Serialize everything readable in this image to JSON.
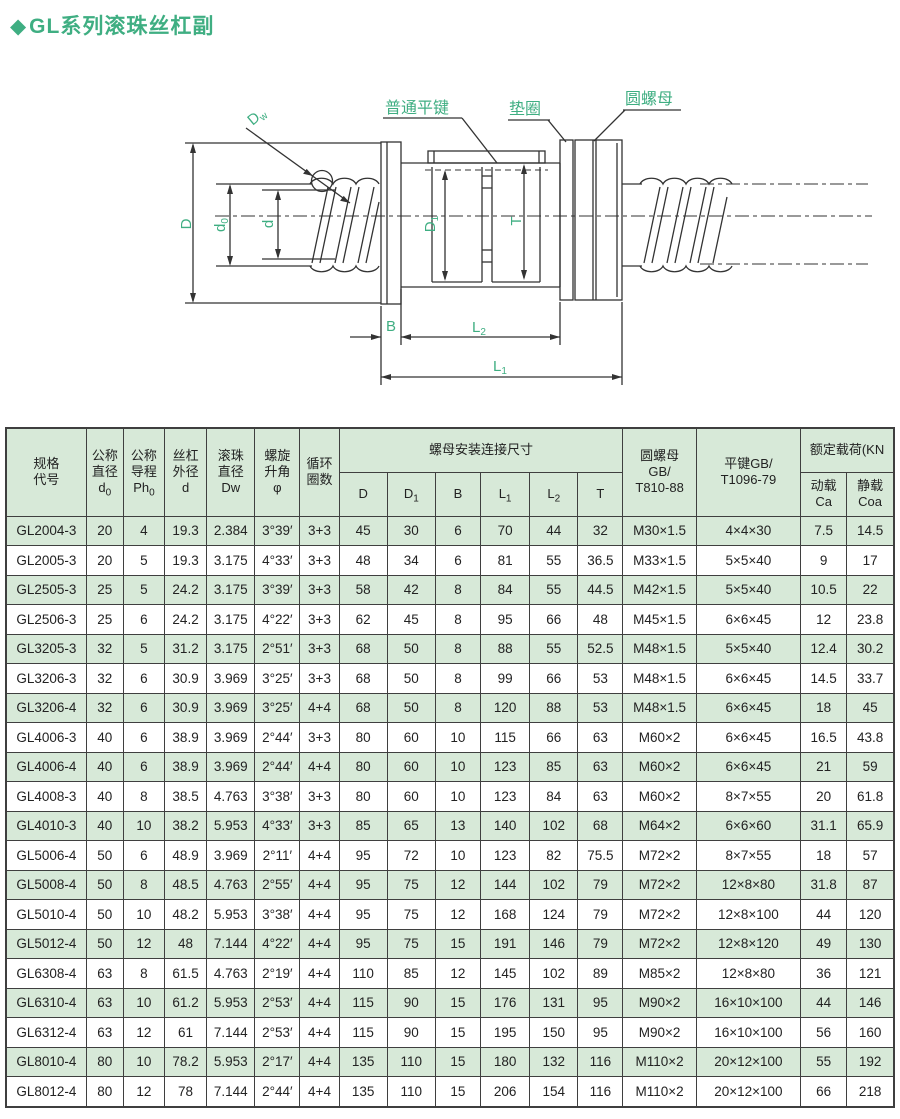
{
  "title": {
    "diamond": "◆",
    "text": "GL系列滚珠丝杠副"
  },
  "colors": {
    "accent_green": "#3fae82",
    "row_green": "#d7e9d8",
    "line_color": "#333333"
  },
  "diagram": {
    "callouts": {
      "flat_key": "普通平键",
      "washer": "垫圈",
      "round_nut": "圆螺母"
    },
    "dims": {
      "D": "D",
      "d0": {
        "sym": "d",
        "sub": "0"
      },
      "d": "d",
      "Dw": {
        "sym": "D",
        "sub": "w"
      },
      "D1": {
        "sym": "D",
        "sub": "1"
      },
      "T": "T",
      "B": "B",
      "L1": {
        "sym": "L",
        "sub": "1"
      },
      "L2": {
        "sym": "L",
        "sub": "2"
      }
    }
  },
  "table": {
    "header": {
      "spec_code": "规格\n代号",
      "nominal_diameter": {
        "label": "公称\n直径",
        "sym": "d",
        "sub": "0"
      },
      "nominal_lead": {
        "label": "公称\n导程",
        "sym": "Ph",
        "sub": "0"
      },
      "screw_od": {
        "label": "丝杠\n外径",
        "sym": "d",
        "sub": ""
      },
      "ball_diameter": {
        "label": "滚珠\n直径",
        "sym": "Dw",
        "sub": ""
      },
      "helix_angle": {
        "label": "螺旋\n升角",
        "sym": "φ",
        "sub": ""
      },
      "circuits": "循环\n圈数",
      "nut_mount_dims": "螺母安装连接尺寸",
      "round_nut_std": "圆螺母\nGB/\nT810-88",
      "flat_key_std": "平键GB/\nT1096-79",
      "rated_load": "额定载荷(KN",
      "dim_cols": [
        {
          "sym": "D",
          "sub": ""
        },
        {
          "sym": "D",
          "sub": "1"
        },
        {
          "sym": "B",
          "sub": ""
        },
        {
          "sym": "L",
          "sub": "1"
        },
        {
          "sym": "L",
          "sub": "2"
        },
        {
          "sym": "T",
          "sub": ""
        }
      ],
      "load_cols": [
        "动载\nCa",
        "静载\nCoa"
      ]
    },
    "rows": [
      [
        "GL2004-3",
        "20",
        "4",
        "19.3",
        "2.384",
        "3°39′",
        "3+3",
        "45",
        "30",
        "6",
        "70",
        "44",
        "32",
        "M30×1.5",
        "4×4×30",
        "7.5",
        "14.5"
      ],
      [
        "GL2005-3",
        "20",
        "5",
        "19.3",
        "3.175",
        "4°33′",
        "3+3",
        "48",
        "34",
        "6",
        "81",
        "55",
        "36.5",
        "M33×1.5",
        "5×5×40",
        "9",
        "17"
      ],
      [
        "GL2505-3",
        "25",
        "5",
        "24.2",
        "3.175",
        "3°39′",
        "3+3",
        "58",
        "42",
        "8",
        "84",
        "55",
        "44.5",
        "M42×1.5",
        "5×5×40",
        "10.5",
        "22"
      ],
      [
        "GL2506-3",
        "25",
        "6",
        "24.2",
        "3.175",
        "4°22′",
        "3+3",
        "62",
        "45",
        "8",
        "95",
        "66",
        "48",
        "M45×1.5",
        "6×6×45",
        "12",
        "23.8"
      ],
      [
        "GL3205-3",
        "32",
        "5",
        "31.2",
        "3.175",
        "2°51′",
        "3+3",
        "68",
        "50",
        "8",
        "88",
        "55",
        "52.5",
        "M48×1.5",
        "5×5×40",
        "12.4",
        "30.2"
      ],
      [
        "GL3206-3",
        "32",
        "6",
        "30.9",
        "3.969",
        "3°25′",
        "3+3",
        "68",
        "50",
        "8",
        "99",
        "66",
        "53",
        "M48×1.5",
        "6×6×45",
        "14.5",
        "33.7"
      ],
      [
        "GL3206-4",
        "32",
        "6",
        "30.9",
        "3.969",
        "3°25′",
        "4+4",
        "68",
        "50",
        "8",
        "120",
        "88",
        "53",
        "M48×1.5",
        "6×6×45",
        "18",
        "45"
      ],
      [
        "GL4006-3",
        "40",
        "6",
        "38.9",
        "3.969",
        "2°44′",
        "3+3",
        "80",
        "60",
        "10",
        "115",
        "66",
        "63",
        "M60×2",
        "6×6×45",
        "16.5",
        "43.8"
      ],
      [
        "GL4006-4",
        "40",
        "6",
        "38.9",
        "3.969",
        "2°44′",
        "4+4",
        "80",
        "60",
        "10",
        "123",
        "85",
        "63",
        "M60×2",
        "6×6×45",
        "21",
        "59"
      ],
      [
        "GL4008-3",
        "40",
        "8",
        "38.5",
        "4.763",
        "3°38′",
        "3+3",
        "80",
        "60",
        "10",
        "123",
        "84",
        "63",
        "M60×2",
        "8×7×55",
        "20",
        "61.8"
      ],
      [
        "GL4010-3",
        "40",
        "10",
        "38.2",
        "5.953",
        "4°33′",
        "3+3",
        "85",
        "65",
        "13",
        "140",
        "102",
        "68",
        "M64×2",
        "6×6×60",
        "31.1",
        "65.9"
      ],
      [
        "GL5006-4",
        "50",
        "6",
        "48.9",
        "3.969",
        "2°11′",
        "4+4",
        "95",
        "72",
        "10",
        "123",
        "82",
        "75.5",
        "M72×2",
        "8×7×55",
        "18",
        "57"
      ],
      [
        "GL5008-4",
        "50",
        "8",
        "48.5",
        "4.763",
        "2°55′",
        "4+4",
        "95",
        "75",
        "12",
        "144",
        "102",
        "79",
        "M72×2",
        "12×8×80",
        "31.8",
        "87"
      ],
      [
        "GL5010-4",
        "50",
        "10",
        "48.2",
        "5.953",
        "3°38′",
        "4+4",
        "95",
        "75",
        "12",
        "168",
        "124",
        "79",
        "M72×2",
        "12×8×100",
        "44",
        "120"
      ],
      [
        "GL5012-4",
        "50",
        "12",
        "48",
        "7.144",
        "4°22′",
        "4+4",
        "95",
        "75",
        "15",
        "191",
        "146",
        "79",
        "M72×2",
        "12×8×120",
        "49",
        "130"
      ],
      [
        "GL6308-4",
        "63",
        "8",
        "61.5",
        "4.763",
        "2°19′",
        "4+4",
        "110",
        "85",
        "12",
        "145",
        "102",
        "89",
        "M85×2",
        "12×8×80",
        "36",
        "121"
      ],
      [
        "GL6310-4",
        "63",
        "10",
        "61.2",
        "5.953",
        "2°53′",
        "4+4",
        "115",
        "90",
        "15",
        "176",
        "131",
        "95",
        "M90×2",
        "16×10×100",
        "44",
        "146"
      ],
      [
        "GL6312-4",
        "63",
        "12",
        "61",
        "7.144",
        "2°53′",
        "4+4",
        "115",
        "90",
        "15",
        "195",
        "150",
        "95",
        "M90×2",
        "16×10×100",
        "56",
        "160"
      ],
      [
        "GL8010-4",
        "80",
        "10",
        "78.2",
        "5.953",
        "2°17′",
        "4+4",
        "135",
        "110",
        "15",
        "180",
        "132",
        "116",
        "M110×2",
        "20×12×100",
        "55",
        "192"
      ],
      [
        "GL8012-4",
        "80",
        "12",
        "78",
        "7.144",
        "2°44′",
        "4+4",
        "135",
        "110",
        "15",
        "206",
        "154",
        "116",
        "M110×2",
        "20×12×100",
        "66",
        "218"
      ]
    ]
  }
}
